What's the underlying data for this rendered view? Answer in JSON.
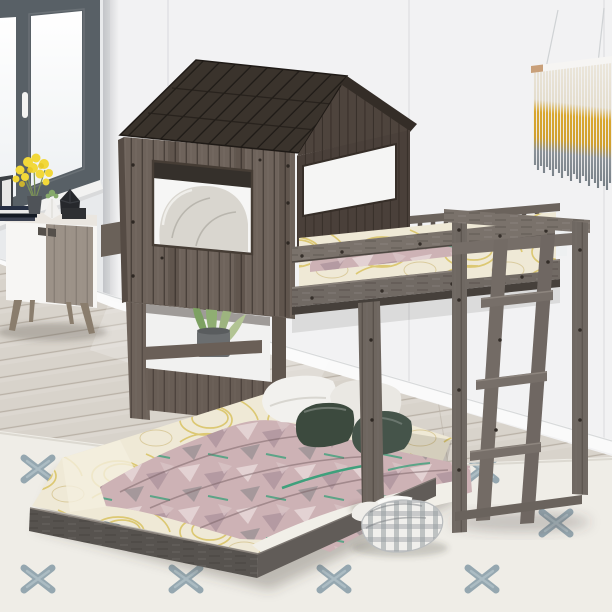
{
  "meta": {
    "image_type": "product-photo",
    "subject": "House-shaped wooden loft bunk bed with roof, front window, guardrails and side ladder over a lower full-size platform bed, staged in a bedroom"
  },
  "palette": {
    "wall_right": "#f2f2f3",
    "wall_left": "#e8eaec",
    "wall_seam": "#e1e1e4",
    "baseboard": "#fafafa",
    "floor_wood": "#d8d3cb",
    "floor_line": "#c6c0b6",
    "rug_base": "#efede7",
    "rug_motif": "#7e96a2",
    "window_frame": "#586066",
    "window_pane": "#fbfcfe",
    "roof_dark": "#3a332c",
    "gable_wood": "#4e443d",
    "house_wood": "#6e635b",
    "house_wood_dark": "#5a5049",
    "rail_wood": "#7a726b",
    "rail_wood_mid": "#716a64",
    "bedframe_wood": "#57534f",
    "sheet_cream": "#efe9d6",
    "sheet_loop_yellow": "#d8c261",
    "quilt_mauve": "#cdb2b5",
    "quilt_light": "#e6d6d6",
    "quilt_green": "#3fa07c",
    "pillow_white": "#f2f1ee",
    "pillow_green_dark": "#3c4a3e",
    "hanging_rod": "#f6f5f3",
    "hanging_rod_tip": "#c9a07a",
    "hanging_cream": "#e9e4d8",
    "hanging_yellow": "#d9a72e",
    "hanging_gray": "#7e878c",
    "cabinet_white": "#f7f6f4",
    "cabinet_wood": "#9c9288",
    "cabinet_leg": "#8a7d6d",
    "flower_yellow": "#f2d839",
    "plant_green": "#9db47f",
    "pot_gray": "#6b6e70",
    "plaid_cloth": "#aeb2b5",
    "interior_shadow": "#35302b"
  },
  "scene": {
    "room": {
      "label": "bedroom corner with white panel walls, casement window, wood floor and patterned area rug"
    },
    "window": {
      "label": "gray casement window with white handle",
      "sashes": 2
    },
    "wall_hanging": {
      "label": "fringe macrame wall hanging on white rod",
      "bands": [
        "cream",
        "mustard yellow",
        "gray"
      ]
    },
    "cabinet": {
      "label": "mid-century sideboard with white and oak doors, splayed legs",
      "decor": [
        "picture frame",
        "stacked books",
        "yellow flower bouquet in vase",
        "white geometric succulent planter",
        "black faceted planter"
      ]
    },
    "loft_bed": {
      "label": "antique gray wood house loft bed",
      "parts": [
        "dark plank roof",
        "gable end",
        "front window with pillow",
        "rear window opening",
        "lower wall window with potted plant",
        "guardrails",
        "footboard with ladder",
        "support posts"
      ]
    },
    "upper_bedding": {
      "label": "cream sheet with yellow loop print and mauve patterned quilt"
    },
    "lower_bed": {
      "label": "full-size platform bed with gray wood frame",
      "bedding": [
        "cream sheet with yellow loop print",
        "mauve geometric quilt with green accents",
        "white folded sheet",
        "2 white pillows",
        "2 dark green velvet pillows"
      ]
    },
    "rug": {
      "label": "cream area rug with blue-gray brushstroke cross motifs"
    },
    "plaid_blanket": {
      "label": "folded white-gray gingham blanket on rug"
    },
    "plant": {
      "label": "green leafy plant in gray cylinder pot behind lower wall window"
    }
  }
}
